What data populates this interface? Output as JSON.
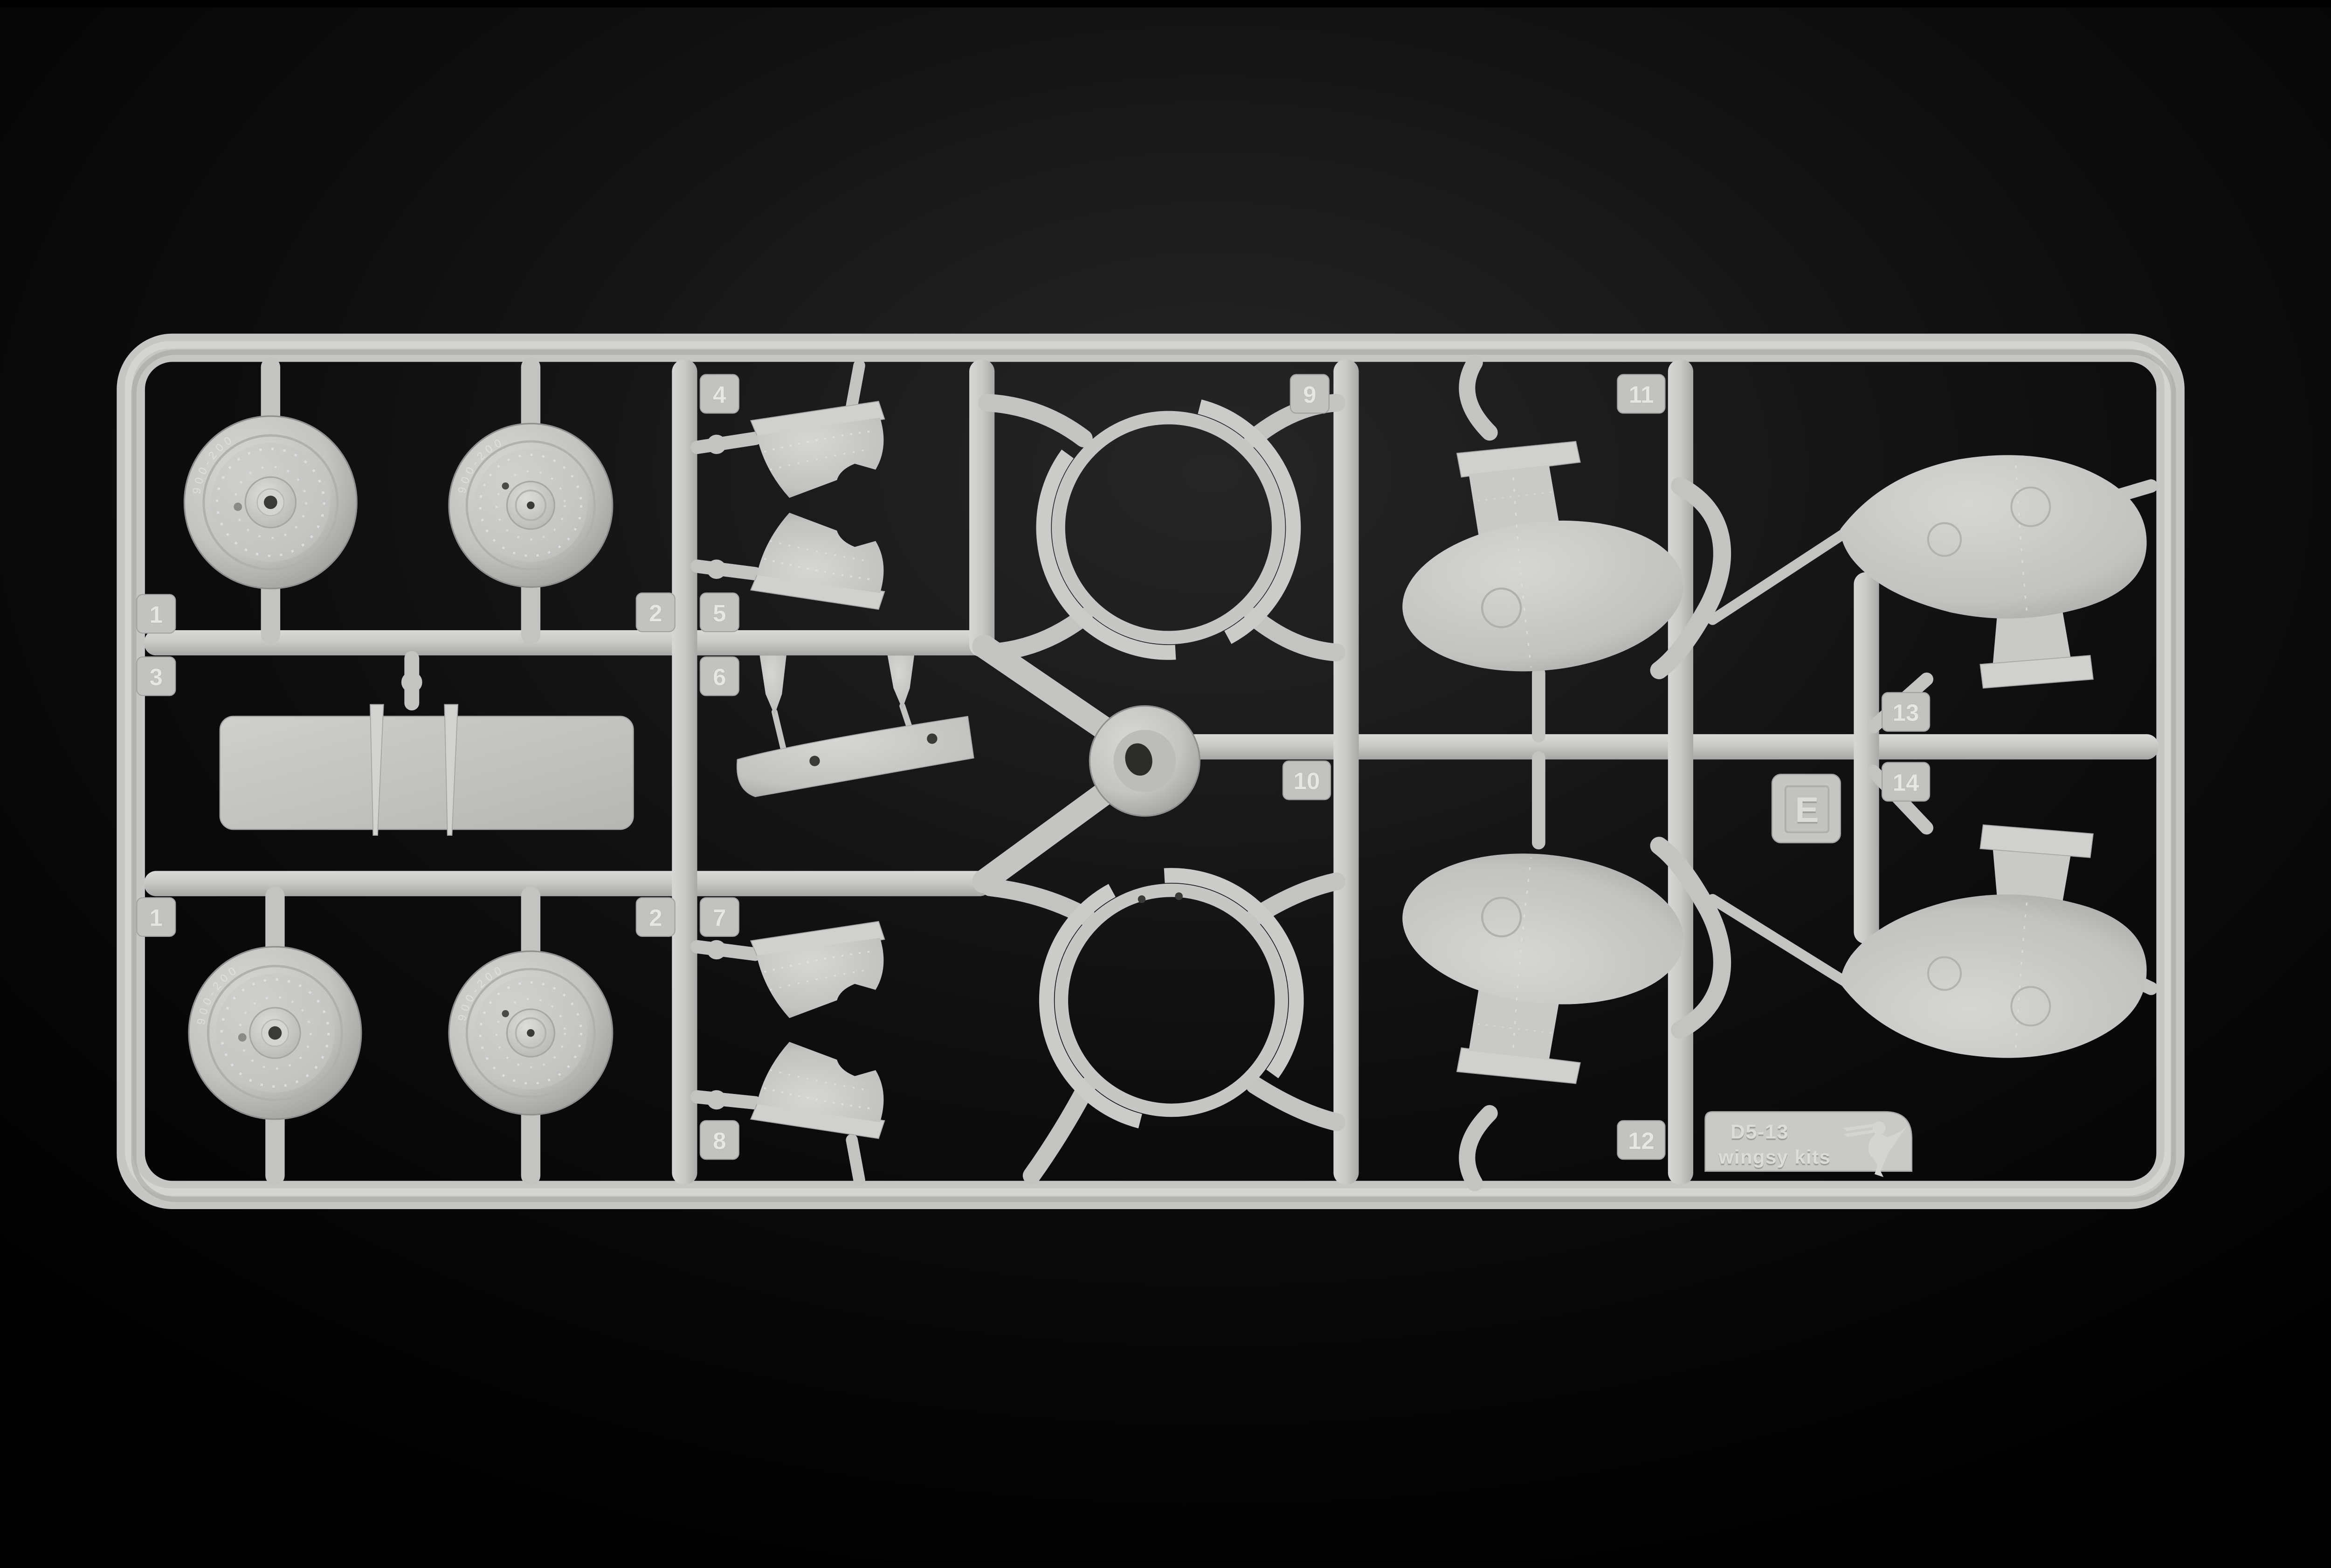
{
  "scene": {
    "description": "Light grey injection-moulded plastic model kit sprue (runner frame E) photographed on a black background",
    "background_color": "#000000",
    "plastic_color": "#c6c6c4",
    "shadow_color": "#9a9a98",
    "highlight_color": "#e2e2e0"
  },
  "labels": {
    "n1": "1",
    "n2": "2",
    "n3": "3",
    "n4": "4",
    "n5": "5",
    "n6": "6",
    "n7": "7",
    "n8": "8",
    "n9": "9",
    "n10": "10",
    "n11": "11",
    "n12": "12",
    "n13": "13",
    "n14": "14"
  },
  "plate": {
    "letter": "E",
    "kit_code": "D5-13",
    "brand": "wingsy kits"
  },
  "tire": {
    "marking": "900-200"
  },
  "parts": [
    {
      "number": "1",
      "description": "main wheel outer half (two on sprue, embossed tyre lettering)"
    },
    {
      "number": "2",
      "description": "main wheel inner half (two on sprue)"
    },
    {
      "number": "3",
      "description": "flat stabilizer panel with two tapered trim strips laid across it"
    },
    {
      "number": "4",
      "description": "riveted cowling side panel, upper pair"
    },
    {
      "number": "5",
      "description": "riveted cowling side panel, upper pair mirrored"
    },
    {
      "number": "6",
      "description": "long tapered under-fairing trough with two mounting pegs"
    },
    {
      "number": "7",
      "description": "riveted cowling side panel, lower pair"
    },
    {
      "number": "8",
      "description": "riveted cowling side panel, lower pair mirrored"
    },
    {
      "number": "9",
      "description": "open engine cowling ring, upper"
    },
    {
      "number": "10",
      "description": "open engine cowling ring, lower (two rigging holes)"
    },
    {
      "number": "11",
      "description": "engine nacelle half with neck and top flange"
    },
    {
      "number": "12",
      "description": "engine nacelle half, vertically mirrored"
    },
    {
      "number": "13",
      "description": "teardrop fairing half with bottom neck flange"
    },
    {
      "number": "14",
      "description": "teardrop fairing half, vertically mirrored"
    }
  ]
}
